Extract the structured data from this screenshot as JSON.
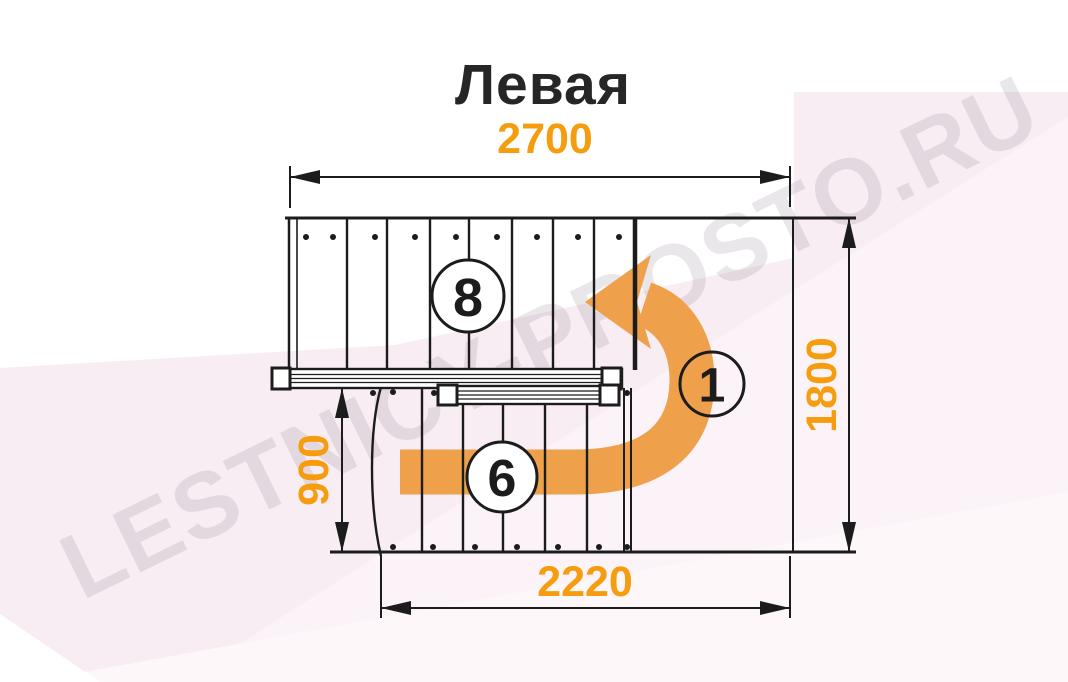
{
  "title": "Левая",
  "watermark": "LESTNICY-PROSTO.RU",
  "dimensions": {
    "top_width": "2700",
    "right_height": "1800",
    "left_run": "900",
    "bottom_width": "2220"
  },
  "step_markers": {
    "upper_flight": "8",
    "turn_start": "1",
    "lower_flight": "6"
  },
  "colors": {
    "dimension_text": "#F59D0F",
    "arrow_fill": "#EFA04B",
    "line": "#1C1C1C",
    "background_tint": "#F8EDF3",
    "watermark_text": "#E6E0E6"
  }
}
